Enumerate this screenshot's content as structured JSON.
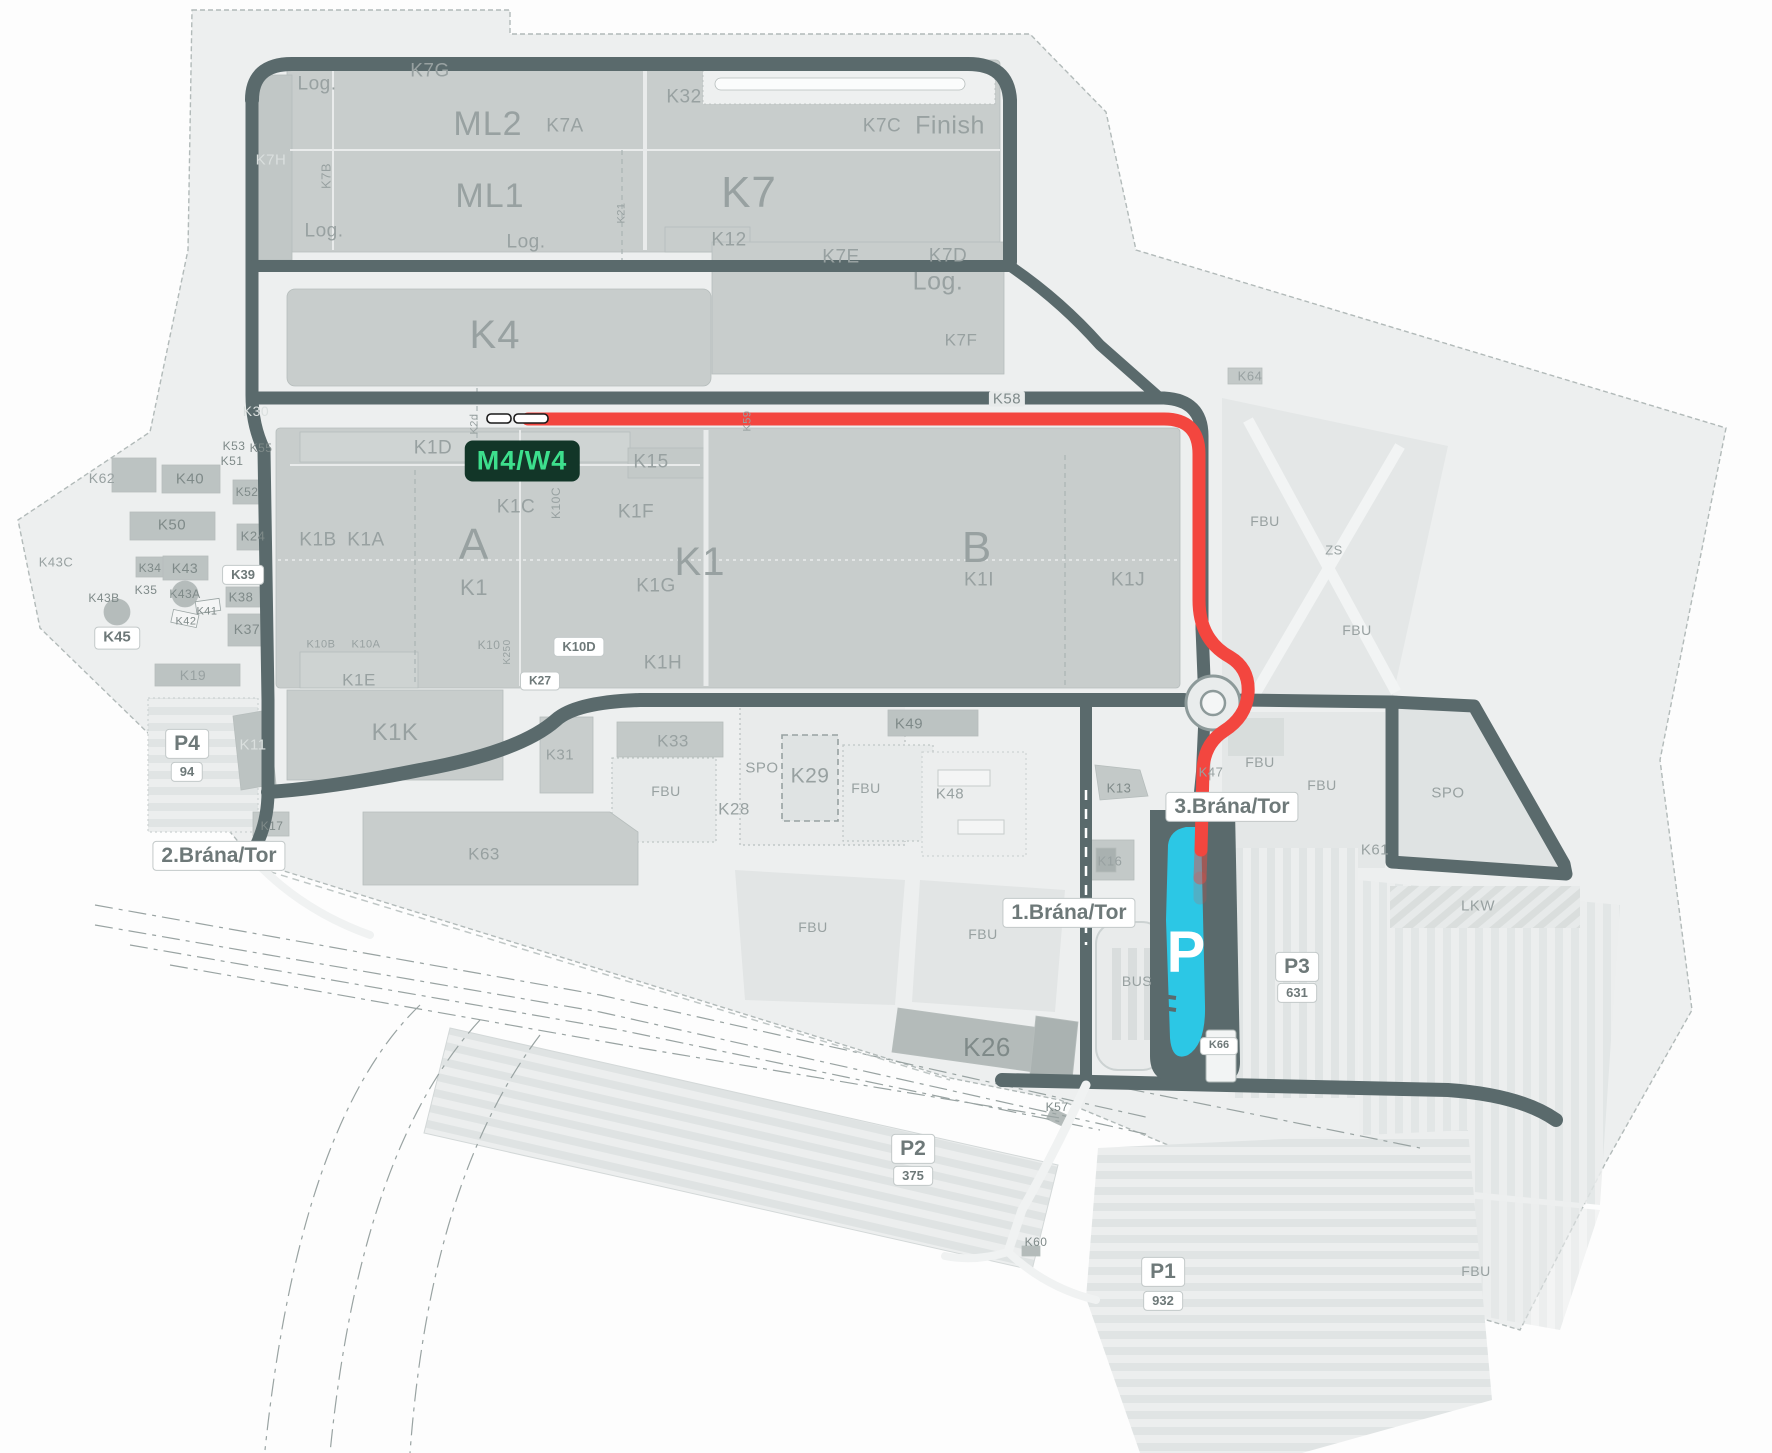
{
  "map": {
    "title": "plant-site-map",
    "colors": {
      "route": "#f3463f",
      "parking_highlight": "#2cc7e5",
      "road": "#5a6a6c",
      "building": "#c8cdcc",
      "campus": "#edefef",
      "highlight_bg": "#123628",
      "highlight_fg": "#3ddf8d"
    },
    "highlight": {
      "text": "M4/W4",
      "x": 522,
      "y": 461
    },
    "parking_p": {
      "letter": "P",
      "x": 1186,
      "y": 952
    },
    "gates": [
      {
        "name": "1.Brána/Tor"
      },
      {
        "name": "2.Brána/Tor"
      },
      {
        "name": "3.Brána/Tor"
      }
    ],
    "parkings": [
      {
        "name": "P1",
        "capacity": "932"
      },
      {
        "name": "P2",
        "capacity": "375"
      },
      {
        "name": "P3",
        "capacity": "631"
      },
      {
        "name": "P4",
        "capacity": "94"
      }
    ],
    "badges": [
      {
        "t": "2.Brána/Tor",
        "x": 219,
        "y": 856,
        "s": 21
      },
      {
        "t": "1.Brána/Tor",
        "x": 1069,
        "y": 913,
        "s": 21
      },
      {
        "t": "3.Brána/Tor",
        "x": 1232,
        "y": 807,
        "s": 21
      },
      {
        "t": "P4",
        "x": 187,
        "y": 744,
        "s": 21
      },
      {
        "t": "94",
        "x": 187,
        "y": 772,
        "s": 13
      },
      {
        "t": "P3",
        "x": 1297,
        "y": 967,
        "s": 21
      },
      {
        "t": "631",
        "x": 1297,
        "y": 993,
        "s": 13
      },
      {
        "t": "P2",
        "x": 913,
        "y": 1149,
        "s": 21
      },
      {
        "t": "375",
        "x": 913,
        "y": 1176,
        "s": 13
      },
      {
        "t": "P1",
        "x": 1163,
        "y": 1272,
        "s": 21
      },
      {
        "t": "932",
        "x": 1163,
        "y": 1301,
        "s": 13
      },
      {
        "t": "K45",
        "x": 117,
        "y": 638,
        "s": 15
      },
      {
        "t": "K39",
        "x": 243,
        "y": 575,
        "s": 13
      },
      {
        "t": "K27",
        "x": 540,
        "y": 681,
        "s": 12
      },
      {
        "t": "K10D",
        "x": 579,
        "y": 647,
        "s": 13
      },
      {
        "t": "K66",
        "x": 1219,
        "y": 1046,
        "s": 11
      }
    ],
    "labels": [
      {
        "t": "Log.",
        "x": 317,
        "y": 84,
        "s": 19
      },
      {
        "t": "K7G",
        "x": 430,
        "y": 71,
        "s": 19
      },
      {
        "t": "ML2",
        "x": 488,
        "y": 124,
        "s": 34,
        "c": "big"
      },
      {
        "t": "K7A",
        "x": 565,
        "y": 126,
        "s": 19
      },
      {
        "t": "K32",
        "x": 684,
        "y": 97,
        "s": 19
      },
      {
        "t": "K7C",
        "x": 882,
        "y": 126,
        "s": 19
      },
      {
        "t": "Finish",
        "x": 950,
        "y": 126,
        "s": 25
      },
      {
        "t": "K7H",
        "x": 271,
        "y": 160,
        "s": 15,
        "c": "light"
      },
      {
        "t": "K7B",
        "x": 326,
        "y": 176,
        "s": 13,
        "r": -90
      },
      {
        "t": "ML1",
        "x": 490,
        "y": 196,
        "s": 34,
        "c": "big"
      },
      {
        "t": "K7",
        "x": 749,
        "y": 193,
        "s": 44,
        "c": "big"
      },
      {
        "t": "K21",
        "x": 622,
        "y": 213,
        "s": 11,
        "r": -90
      },
      {
        "t": "Log.",
        "x": 324,
        "y": 231,
        "s": 19
      },
      {
        "t": "Log.",
        "x": 526,
        "y": 242,
        "s": 19
      },
      {
        "t": "K12",
        "x": 729,
        "y": 240,
        "s": 19
      },
      {
        "t": "K7E",
        "x": 841,
        "y": 257,
        "s": 19
      },
      {
        "t": "K7D",
        "x": 948,
        "y": 256,
        "s": 19
      },
      {
        "t": "Log.",
        "x": 938,
        "y": 282,
        "s": 25
      },
      {
        "t": "K7F",
        "x": 961,
        "y": 340,
        "s": 17
      },
      {
        "t": "K4",
        "x": 495,
        "y": 335,
        "s": 40,
        "c": "big"
      },
      {
        "t": "K30",
        "x": 256,
        "y": 411,
        "s": 14,
        "c": "light"
      },
      {
        "t": "K58",
        "x": 1007,
        "y": 399,
        "s": 15,
        "c": "roadbadge"
      },
      {
        "t": "K64",
        "x": 1250,
        "y": 376,
        "s": 13
      },
      {
        "t": "K53",
        "x": 234,
        "y": 446,
        "s": 12,
        "c": "dark"
      },
      {
        "t": "K55",
        "x": 261,
        "y": 448,
        "s": 12,
        "c": "dark"
      },
      {
        "t": "K51",
        "x": 232,
        "y": 461,
        "s": 12,
        "c": "dark"
      },
      {
        "t": "K59",
        "x": 748,
        "y": 421,
        "s": 11,
        "r": -90
      },
      {
        "t": "K2d",
        "x": 475,
        "y": 424,
        "s": 11,
        "r": -90
      },
      {
        "t": "K1D",
        "x": 433,
        "y": 448,
        "s": 19
      },
      {
        "t": "K15",
        "x": 651,
        "y": 462,
        "s": 19
      },
      {
        "t": "K62",
        "x": 102,
        "y": 478,
        "s": 14
      },
      {
        "t": "K40",
        "x": 190,
        "y": 479,
        "s": 15,
        "c": "dark"
      },
      {
        "t": "K52",
        "x": 247,
        "y": 492,
        "s": 12,
        "c": "dark"
      },
      {
        "t": "K1C",
        "x": 516,
        "y": 507,
        "s": 19
      },
      {
        "t": "K10C",
        "x": 556,
        "y": 503,
        "s": 12,
        "r": -90
      },
      {
        "t": "K1F",
        "x": 636,
        "y": 512,
        "s": 19
      },
      {
        "t": "FBU",
        "x": 1265,
        "y": 521,
        "s": 14
      },
      {
        "t": "K50",
        "x": 172,
        "y": 525,
        "s": 15,
        "c": "dark"
      },
      {
        "t": "K24",
        "x": 253,
        "y": 536,
        "s": 13,
        "c": "dark"
      },
      {
        "t": "K1B",
        "x": 318,
        "y": 540,
        "s": 19
      },
      {
        "t": "K1A",
        "x": 366,
        "y": 540,
        "s": 19
      },
      {
        "t": "A",
        "x": 474,
        "y": 545,
        "s": 44,
        "c": "big"
      },
      {
        "t": "K1",
        "x": 700,
        "y": 562,
        "s": 40,
        "c": "big"
      },
      {
        "t": "ZS",
        "x": 1334,
        "y": 550,
        "s": 13
      },
      {
        "t": "B",
        "x": 977,
        "y": 548,
        "s": 44,
        "c": "big"
      },
      {
        "t": "K43C",
        "x": 56,
        "y": 562,
        "s": 13
      },
      {
        "t": "K34",
        "x": 150,
        "y": 568,
        "s": 12,
        "c": "dark"
      },
      {
        "t": "K43",
        "x": 185,
        "y": 568,
        "s": 14,
        "c": "dark"
      },
      {
        "t": "K1",
        "x": 474,
        "y": 588,
        "s": 22
      },
      {
        "t": "K1G",
        "x": 656,
        "y": 586,
        "s": 19
      },
      {
        "t": "K1I",
        "x": 979,
        "y": 580,
        "s": 19
      },
      {
        "t": "K1J",
        "x": 1128,
        "y": 580,
        "s": 19
      },
      {
        "t": "K35",
        "x": 146,
        "y": 590,
        "s": 12,
        "c": "dark"
      },
      {
        "t": "K43A",
        "x": 185,
        "y": 594,
        "s": 12,
        "c": "dark"
      },
      {
        "t": "K38",
        "x": 241,
        "y": 597,
        "s": 13,
        "c": "dark"
      },
      {
        "t": "K43B",
        "x": 104,
        "y": 598,
        "s": 12,
        "c": "dark"
      },
      {
        "t": "K41",
        "x": 207,
        "y": 612,
        "s": 11,
        "c": "dark"
      },
      {
        "t": "K42",
        "x": 186,
        "y": 622,
        "s": 11,
        "c": "dark"
      },
      {
        "t": "K37",
        "x": 247,
        "y": 629,
        "s": 14,
        "c": "dark"
      },
      {
        "t": "K10B",
        "x": 321,
        "y": 645,
        "s": 11
      },
      {
        "t": "K10A",
        "x": 366,
        "y": 645,
        "s": 11
      },
      {
        "t": "K10",
        "x": 489,
        "y": 645,
        "s": 12
      },
      {
        "t": "K250",
        "x": 508,
        "y": 652,
        "s": 10,
        "r": -90
      },
      {
        "t": "K1H",
        "x": 663,
        "y": 663,
        "s": 19
      },
      {
        "t": "K19",
        "x": 193,
        "y": 675,
        "s": 14
      },
      {
        "t": "K1E",
        "x": 359,
        "y": 680,
        "s": 17
      },
      {
        "t": "K1K",
        "x": 395,
        "y": 733,
        "s": 24
      },
      {
        "t": "K11",
        "x": 253,
        "y": 745,
        "s": 15,
        "c": "light"
      },
      {
        "t": "K49",
        "x": 909,
        "y": 724,
        "s": 15,
        "c": "dark"
      },
      {
        "t": "K31",
        "x": 560,
        "y": 755,
        "s": 15
      },
      {
        "t": "K33",
        "x": 673,
        "y": 741,
        "s": 17
      },
      {
        "t": "SPO",
        "x": 762,
        "y": 768,
        "s": 15
      },
      {
        "t": "K29",
        "x": 810,
        "y": 776,
        "s": 21
      },
      {
        "t": "FBU",
        "x": 666,
        "y": 791,
        "s": 14
      },
      {
        "t": "K28",
        "x": 734,
        "y": 809,
        "s": 17
      },
      {
        "t": "FBU",
        "x": 866,
        "y": 788,
        "s": 14
      },
      {
        "t": "K48",
        "x": 950,
        "y": 794,
        "s": 15
      },
      {
        "t": "FBU",
        "x": 1260,
        "y": 762,
        "s": 14
      },
      {
        "t": "K13",
        "x": 1119,
        "y": 788,
        "s": 13,
        "c": "dark"
      },
      {
        "t": "K47",
        "x": 1211,
        "y": 772,
        "s": 13
      },
      {
        "t": "FBU",
        "x": 1322,
        "y": 785,
        "s": 14
      },
      {
        "t": "SPO",
        "x": 1448,
        "y": 793,
        "s": 15
      },
      {
        "t": "K61",
        "x": 1375,
        "y": 850,
        "s": 15
      },
      {
        "t": "FBU",
        "x": 1357,
        "y": 630,
        "s": 14
      },
      {
        "t": "K17",
        "x": 272,
        "y": 826,
        "s": 12,
        "c": "dark"
      },
      {
        "t": "K63",
        "x": 484,
        "y": 854,
        "s": 17
      },
      {
        "t": "K16",
        "x": 1110,
        "y": 861,
        "s": 13
      },
      {
        "t": "LKW",
        "x": 1478,
        "y": 906,
        "s": 15
      },
      {
        "t": "FBU",
        "x": 813,
        "y": 927,
        "s": 14
      },
      {
        "t": "FBU",
        "x": 983,
        "y": 934,
        "s": 14
      },
      {
        "t": "BUS",
        "x": 1137,
        "y": 981,
        "s": 14
      },
      {
        "t": "K26",
        "x": 987,
        "y": 1047,
        "s": 26,
        "c": "dark"
      },
      {
        "t": "K57",
        "x": 1057,
        "y": 1107,
        "s": 12,
        "c": "dark"
      },
      {
        "t": "K60",
        "x": 1036,
        "y": 1242,
        "s": 12,
        "c": "dark"
      },
      {
        "t": "FBU",
        "x": 1476,
        "y": 1271,
        "s": 14
      }
    ]
  }
}
